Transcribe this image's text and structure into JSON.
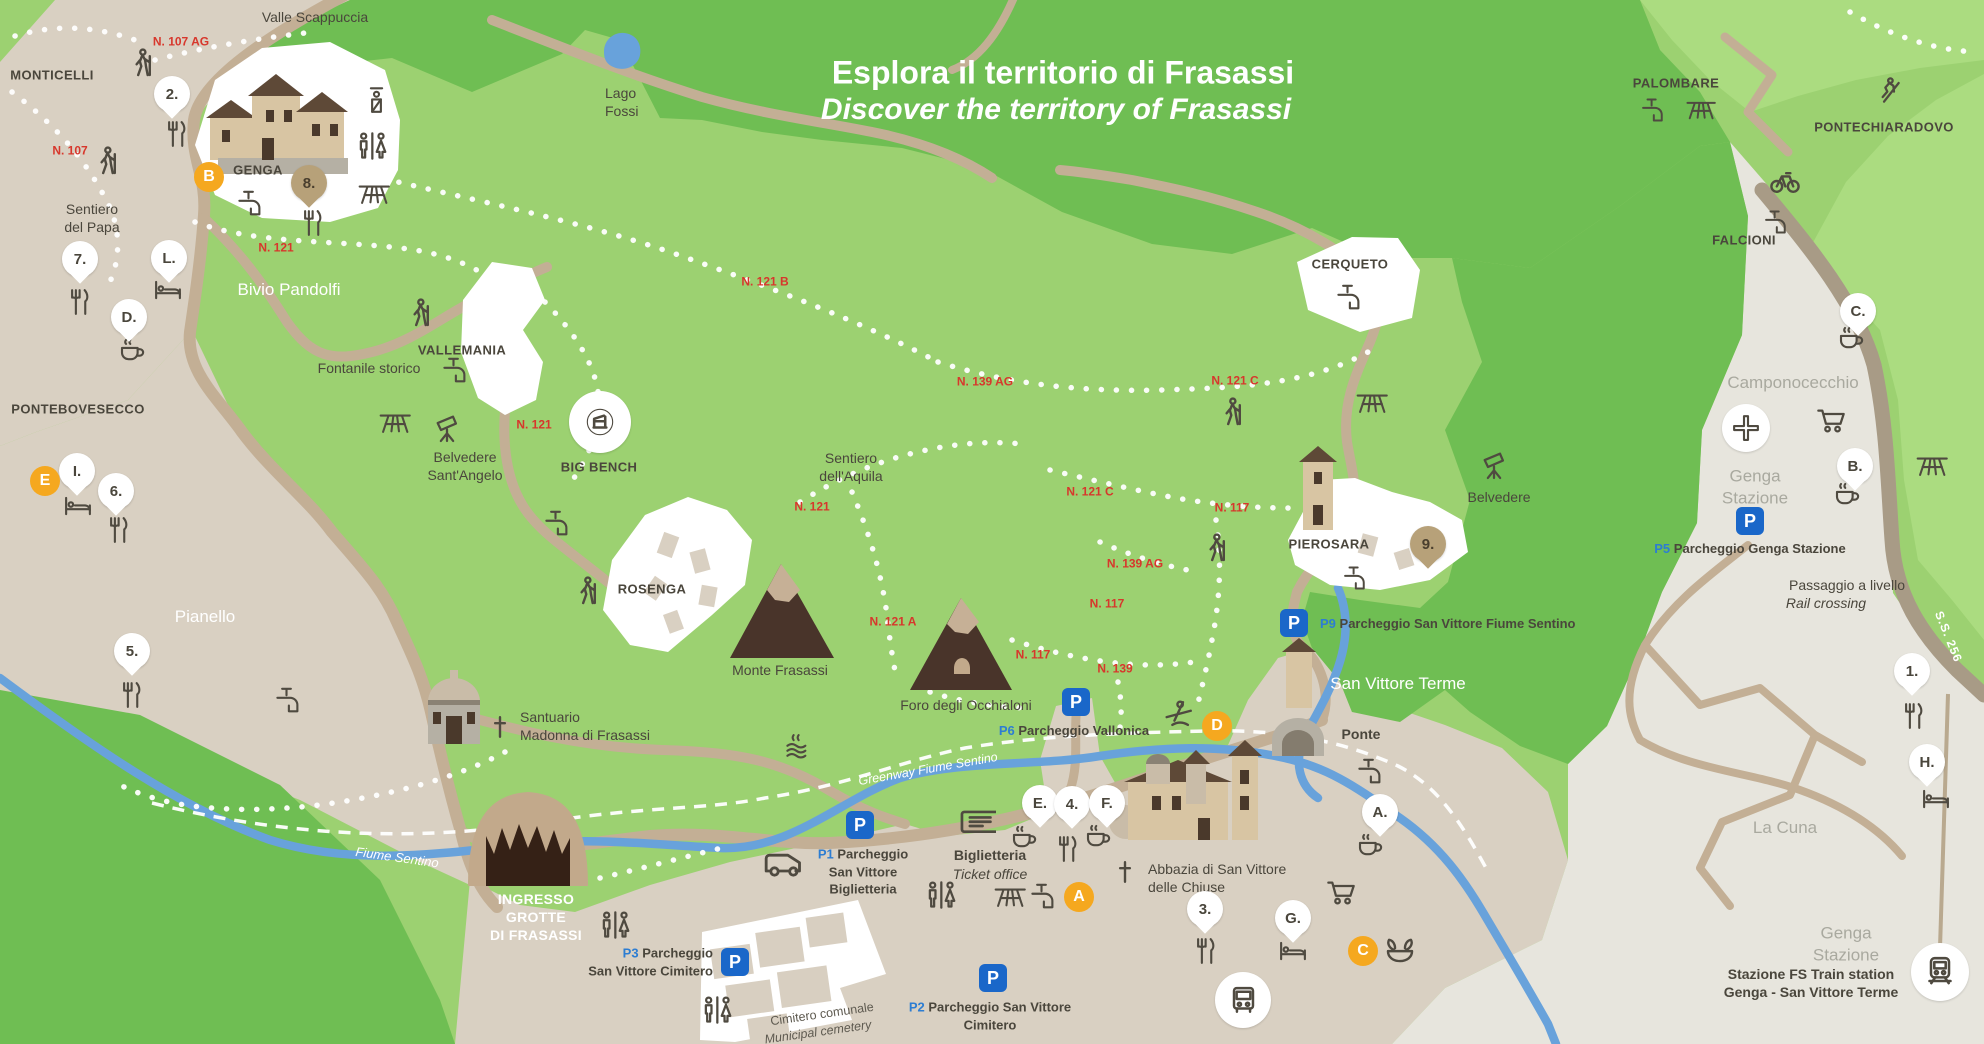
{
  "title": {
    "line1": "Esplora il territorio di Frasassi",
    "line2": "Discover the territory of Frasassi"
  },
  "colors": {
    "light_green": "#9CD171",
    "dark_green": "#6FBE53",
    "bright_green": "#ABDC80",
    "beige": "#D9D0C2",
    "gray_zone": "#E7E5DD",
    "road": "#C3AF95",
    "major_road": "#A89B86",
    "river": "#68A2DB",
    "trail_red": "#D7372C",
    "parking_blue": "#1A67C9",
    "parking_text_blue": "#2D7DD2",
    "orange_marker": "#F5A81F",
    "pin_brown": "#B7A179",
    "text_dark": "#4A463C",
    "text_gray": "#A9A99F"
  },
  "map": {
    "labels": [
      {
        "t": [
          "Valle Scappuccia"
        ],
        "x": 315,
        "y": 18,
        "cls": "poi"
      },
      {
        "t": [
          "MONTICELLI"
        ],
        "x": 52,
        "y": 76,
        "cls": "vil"
      },
      {
        "t": [
          "GENGA"
        ],
        "x": 258,
        "y": 171,
        "cls": "vil"
      },
      {
        "t": [
          "Sentiero",
          "del Papa"
        ],
        "x": 92,
        "y": 219,
        "cls": "poi"
      },
      {
        "t": [
          "Bivio Pandolfi"
        ],
        "x": 289,
        "y": 290,
        "cls": "wvil"
      },
      {
        "t": [
          "VALLEMANIA"
        ],
        "x": 462,
        "y": 351,
        "cls": "vil"
      },
      {
        "t": [
          "Fontanile storico"
        ],
        "x": 369,
        "y": 369,
        "cls": "poi"
      },
      {
        "t": [
          "Belvedere",
          "Sant'Angelo"
        ],
        "x": 465,
        "y": 467,
        "cls": "poi"
      },
      {
        "t": [
          "BIG BENCH"
        ],
        "x": 599,
        "y": 468,
        "cls": "vil"
      },
      {
        "t": [
          "ROSENGA"
        ],
        "x": 652,
        "y": 590,
        "cls": "vil"
      },
      {
        "t": [
          "Sentiero",
          "dell'Aquila"
        ],
        "x": 851,
        "y": 468,
        "cls": "poi"
      },
      {
        "t": [
          "Monte Frasassi"
        ],
        "x": 780,
        "y": 671,
        "cls": "poi"
      },
      {
        "t": [
          "Foro degli Occhialoni"
        ],
        "x": 966,
        "y": 706,
        "cls": "poi"
      },
      {
        "t": [
          "Santuario",
          "Madonna di Frasassi"
        ],
        "x": 520,
        "y": 727,
        "cls": "poi",
        "align": "left"
      },
      {
        "t": [
          "Pianello"
        ],
        "x": 205,
        "y": 617,
        "cls": "wvil"
      },
      {
        "t": [
          "PONTEBOVESECCO"
        ],
        "x": 78,
        "y": 410,
        "cls": "vil"
      },
      {
        "t": [
          "Lago",
          "Fossi"
        ],
        "x": 605,
        "y": 103,
        "cls": "poi",
        "align": "left"
      },
      {
        "t": [
          "PALOMBARE"
        ],
        "x": 1676,
        "y": 84,
        "cls": "vil"
      },
      {
        "t": [
          "PONTECHIARADOVO"
        ],
        "x": 1884,
        "y": 128,
        "cls": "vil"
      },
      {
        "t": [
          "FALCIONI"
        ],
        "x": 1744,
        "y": 241,
        "cls": "vil"
      },
      {
        "t": [
          "CERQUETO"
        ],
        "x": 1350,
        "y": 265,
        "cls": "vil"
      },
      {
        "t": [
          "PIEROSARA"
        ],
        "x": 1329,
        "y": 545,
        "cls": "vil"
      },
      {
        "t": [
          "Belvedere"
        ],
        "x": 1499,
        "y": 498,
        "cls": "poi"
      },
      {
        "t": [
          "San Vittore Terme"
        ],
        "x": 1398,
        "y": 684,
        "cls": "wvil"
      },
      {
        "t": [
          "Ponte"
        ],
        "x": 1361,
        "y": 735,
        "cls": "poi-b"
      },
      {
        "t": [
          "Camponocecchio"
        ],
        "x": 1793,
        "y": 383,
        "cls": "gray"
      },
      {
        "t": [
          "Genga",
          "Stazione"
        ],
        "x": 1755,
        "y": 487,
        "cls": "gray"
      },
      {
        "t": [
          "La Cuna"
        ],
        "x": 1785,
        "y": 828,
        "cls": "gray"
      },
      {
        "t": [
          "Genga",
          "Stazione"
        ],
        "x": 1846,
        "y": 944,
        "cls": "gray"
      },
      {
        "t": [
          "Stazione FS Train station",
          "Genga - San Vittore Terme"
        ],
        "x": 1811,
        "y": 984,
        "cls": "poi-b"
      },
      {
        "t": [
          "Passaggio a livello"
        ],
        "x": 1847,
        "y": 586,
        "cls": "poi"
      },
      {
        "t": [
          "Rail crossing"
        ],
        "x": 1826,
        "y": 604,
        "cls": "poi-i"
      },
      {
        "t": [
          "Biglietteria"
        ],
        "x": 990,
        "y": 856,
        "cls": "poi-b"
      },
      {
        "t": [
          "Ticket office"
        ],
        "x": 990,
        "y": 875,
        "cls": "poi-i"
      },
      {
        "t": [
          "Abbazia di San Vittore",
          "delle Chiuse"
        ],
        "x": 1148,
        "y": 879,
        "cls": "poi",
        "align": "left"
      },
      {
        "t": [
          "INGRESSO",
          "GROTTE",
          "DI FRASASSI"
        ],
        "x": 536,
        "y": 918,
        "cls": "wb"
      },
      {
        "t": [
          "Fiume Sentino"
        ],
        "x": 397,
        "y": 858,
        "cls": "wit",
        "rot": 8
      },
      {
        "t": [
          "Greenway Fiume Sentino"
        ],
        "x": 928,
        "y": 769,
        "cls": "wit2",
        "rot": -10
      },
      {
        "t": [
          "Cimitero comunale"
        ],
        "x": 822,
        "y": 1014,
        "cls": "cem",
        "rot": -8
      },
      {
        "t": [
          "Municipal cemetery"
        ],
        "x": 818,
        "y": 1032,
        "cls": "cem-i",
        "rot": -8
      },
      {
        "t": [
          "S.S. 256"
        ],
        "x": 1948,
        "y": 637,
        "cls": "road",
        "rot": 68
      }
    ],
    "trail_labels": [
      {
        "t": "N. 107 AG",
        "x": 181,
        "y": 42
      },
      {
        "t": "N. 107",
        "x": 70,
        "y": 151
      },
      {
        "t": "N. 121",
        "x": 276,
        "y": 248
      },
      {
        "t": "N. 121 B",
        "x": 765,
        "y": 282
      },
      {
        "t": "N. 121",
        "x": 534,
        "y": 425
      },
      {
        "t": "N. 121",
        "x": 812,
        "y": 507
      },
      {
        "t": "N. 139 AG",
        "x": 985,
        "y": 382
      },
      {
        "t": "N. 121 C",
        "x": 1235,
        "y": 381
      },
      {
        "t": "N. 121 C",
        "x": 1090,
        "y": 492
      },
      {
        "t": "N. 117",
        "x": 1232,
        "y": 508
      },
      {
        "t": "N. 139 AG",
        "x": 1135,
        "y": 564
      },
      {
        "t": "N. 117",
        "x": 1107,
        "y": 604
      },
      {
        "t": "N. 121 A",
        "x": 893,
        "y": 622
      },
      {
        "t": "N. 117",
        "x": 1033,
        "y": 655
      },
      {
        "t": "N. 139",
        "x": 1115,
        "y": 669
      }
    ],
    "pins": [
      {
        "l": "2.",
        "x": 172,
        "y": 94,
        "icon": "restaurant",
        "ix": 176,
        "iy": 134
      },
      {
        "l": "7.",
        "x": 80,
        "y": 259,
        "icon": "restaurant",
        "ix": 79,
        "iy": 302
      },
      {
        "l": "L.",
        "x": 169,
        "y": 258,
        "icon": "bed",
        "ix": 168,
        "iy": 290
      },
      {
        "l": "D.",
        "x": 129,
        "y": 317,
        "icon": "cafe",
        "ix": 132,
        "iy": 351
      },
      {
        "l": "I.",
        "x": 77,
        "y": 471,
        "icon": "bed",
        "ix": 78,
        "iy": 506
      },
      {
        "l": "6.",
        "x": 116,
        "y": 491,
        "icon": "restaurant",
        "ix": 118,
        "iy": 530
      },
      {
        "l": "5.",
        "x": 132,
        "y": 651,
        "icon": "restaurant",
        "ix": 131,
        "iy": 695
      },
      {
        "l": "E.",
        "x": 1040,
        "y": 803,
        "icon": "cafe",
        "ix": 1024,
        "iy": 838
      },
      {
        "l": "4.",
        "x": 1072,
        "y": 804,
        "icon": "restaurant",
        "ix": 1067,
        "iy": 849
      },
      {
        "l": "F.",
        "x": 1107,
        "y": 803,
        "icon": "cafe",
        "ix": 1098,
        "iy": 837
      },
      {
        "l": "A.",
        "x": 1380,
        "y": 812,
        "icon": "cafe",
        "ix": 1370,
        "iy": 846
      },
      {
        "l": "3.",
        "x": 1205,
        "y": 909,
        "icon": "restaurant",
        "ix": 1205,
        "iy": 951
      },
      {
        "l": "G.",
        "x": 1293,
        "y": 918,
        "icon": "bed",
        "ix": 1293,
        "iy": 951
      },
      {
        "l": "1.",
        "x": 1912,
        "y": 671,
        "icon": "restaurant",
        "ix": 1913,
        "iy": 716
      },
      {
        "l": "H.",
        "x": 1927,
        "y": 762,
        "icon": "bed",
        "ix": 1936,
        "iy": 799
      },
      {
        "l": "B.",
        "x": 1855,
        "y": 466,
        "icon": "cafe",
        "ix": 1847,
        "iy": 495
      },
      {
        "l": "C.",
        "x": 1858,
        "y": 311,
        "icon": "cafe",
        "ix": 1851,
        "iy": 339
      }
    ],
    "brown_pins": [
      {
        "l": "8.",
        "x": 309,
        "y": 183,
        "icon": "restaurant",
        "ix": 312,
        "iy": 223
      },
      {
        "l": "9.",
        "x": 1428,
        "y": 544
      }
    ],
    "orange_markers": [
      {
        "l": "B",
        "x": 209,
        "y": 177
      },
      {
        "l": "E",
        "x": 45,
        "y": 481
      },
      {
        "l": "A",
        "x": 1079,
        "y": 897
      },
      {
        "l": "C",
        "x": 1363,
        "y": 951
      },
      {
        "l": "D",
        "x": 1217,
        "y": 726
      }
    ],
    "parkings": [
      {
        "p": "P1",
        "lines": [
          "Parcheggio",
          "San Vittore",
          "Biglietteria"
        ],
        "x": 860,
        "y": 825,
        "lx": 863,
        "ly": 872,
        "align": "center"
      },
      {
        "p": "P2",
        "lines": [
          "Parcheggio San Vittore",
          "Cimitero"
        ],
        "x": 993,
        "y": 978,
        "lx": 990,
        "ly": 1016,
        "align": "center"
      },
      {
        "p": "P3",
        "lines": [
          "Parcheggio",
          "San Vittore Cimitero"
        ],
        "x": 735,
        "y": 962,
        "lx": 713,
        "ly": 962,
        "align": "right"
      },
      {
        "p": "P5",
        "lines": [
          "Parcheggio Genga Stazione"
        ],
        "x": 1750,
        "y": 521,
        "lx": 1750,
        "ly": 549,
        "align": "center"
      },
      {
        "p": "P6",
        "lines": [
          "Parcheggio Vallonica"
        ],
        "x": 1076,
        "y": 702,
        "lx": 1074,
        "ly": 731,
        "align": "center"
      },
      {
        "p": "P9",
        "lines": [
          "Parcheggio San Vittore Fiume Sentino"
        ],
        "x": 1294,
        "y": 623,
        "lx": 1320,
        "ly": 624,
        "align": "left"
      }
    ],
    "icons": [
      {
        "t": "hiker",
        "x": 142,
        "y": 64,
        "s": 34
      },
      {
        "t": "hiker",
        "x": 107,
        "y": 162,
        "s": 34
      },
      {
        "t": "hiker",
        "x": 420,
        "y": 314,
        "s": 34
      },
      {
        "t": "hiker",
        "x": 587,
        "y": 592,
        "s": 34
      },
      {
        "t": "hiker",
        "x": 1216,
        "y": 549,
        "s": 34
      },
      {
        "t": "hiker",
        "x": 1232,
        "y": 413,
        "s": 34
      },
      {
        "t": "climber",
        "x": 1888,
        "y": 91,
        "s": 32
      },
      {
        "t": "bike",
        "x": 1785,
        "y": 181,
        "s": 34
      },
      {
        "t": "fountain",
        "x": 250,
        "y": 203,
        "s": 30
      },
      {
        "t": "fountain",
        "x": 455,
        "y": 370,
        "s": 30
      },
      {
        "t": "fountain",
        "x": 557,
        "y": 523,
        "s": 30
      },
      {
        "t": "fountain",
        "x": 288,
        "y": 700,
        "s": 30
      },
      {
        "t": "fountain",
        "x": 1043,
        "y": 896,
        "s": 30
      },
      {
        "t": "fountain",
        "x": 1653,
        "y": 110,
        "s": 28
      },
      {
        "t": "fountain",
        "x": 1776,
        "y": 222,
        "s": 28
      },
      {
        "t": "fountain",
        "x": 1349,
        "y": 297,
        "s": 30
      },
      {
        "t": "fountain",
        "x": 1355,
        "y": 578,
        "s": 28
      },
      {
        "t": "fountain",
        "x": 1370,
        "y": 771,
        "s": 30
      },
      {
        "t": "picnic",
        "x": 373,
        "y": 192,
        "s": 34
      },
      {
        "t": "picnic",
        "x": 394,
        "y": 421,
        "s": 34
      },
      {
        "t": "picnic",
        "x": 1371,
        "y": 401,
        "s": 34
      },
      {
        "t": "picnic",
        "x": 1931,
        "y": 464,
        "s": 34
      },
      {
        "t": "picnic",
        "x": 1009,
        "y": 895,
        "s": 34
      },
      {
        "t": "picnic",
        "x": 1700,
        "y": 108,
        "s": 32
      },
      {
        "t": "wc",
        "x": 371,
        "y": 146,
        "s": 32
      },
      {
        "t": "wc",
        "x": 614,
        "y": 925,
        "s": 32
      },
      {
        "t": "wc",
        "x": 716,
        "y": 1010,
        "s": 32
      },
      {
        "t": "wc",
        "x": 940,
        "y": 895,
        "s": 32
      },
      {
        "t": "info-point",
        "x": 374,
        "y": 100,
        "s": 30
      },
      {
        "t": "telescope",
        "x": 449,
        "y": 430,
        "s": 32
      },
      {
        "t": "telescope",
        "x": 1496,
        "y": 467,
        "s": 32
      },
      {
        "t": "ticket",
        "x": 977,
        "y": 823,
        "s": 38
      },
      {
        "t": "camper",
        "x": 782,
        "y": 866,
        "s": 40
      },
      {
        "t": "cart",
        "x": 1341,
        "y": 894,
        "s": 32
      },
      {
        "t": "cart",
        "x": 1831,
        "y": 422,
        "s": 32
      },
      {
        "t": "hot-spring",
        "x": 798,
        "y": 747,
        "s": 30
      },
      {
        "t": "spa-fountain",
        "x": 1400,
        "y": 949,
        "s": 34
      },
      {
        "t": "canoe",
        "x": 1178,
        "y": 715,
        "s": 34
      },
      {
        "t": "church-cross",
        "x": 500,
        "y": 727,
        "s": 26
      },
      {
        "t": "church-cross",
        "x": 1125,
        "y": 872,
        "s": 26
      }
    ],
    "circles": [
      {
        "t": "bus",
        "x": 1243,
        "y": 1000,
        "d": 56
      },
      {
        "t": "train",
        "x": 1940,
        "y": 972,
        "d": 58
      },
      {
        "t": "rail-crossing",
        "x": 1746,
        "y": 428,
        "d": 48
      },
      {
        "t": "big-bench-badge",
        "x": 600,
        "y": 422,
        "d": 62
      }
    ]
  }
}
